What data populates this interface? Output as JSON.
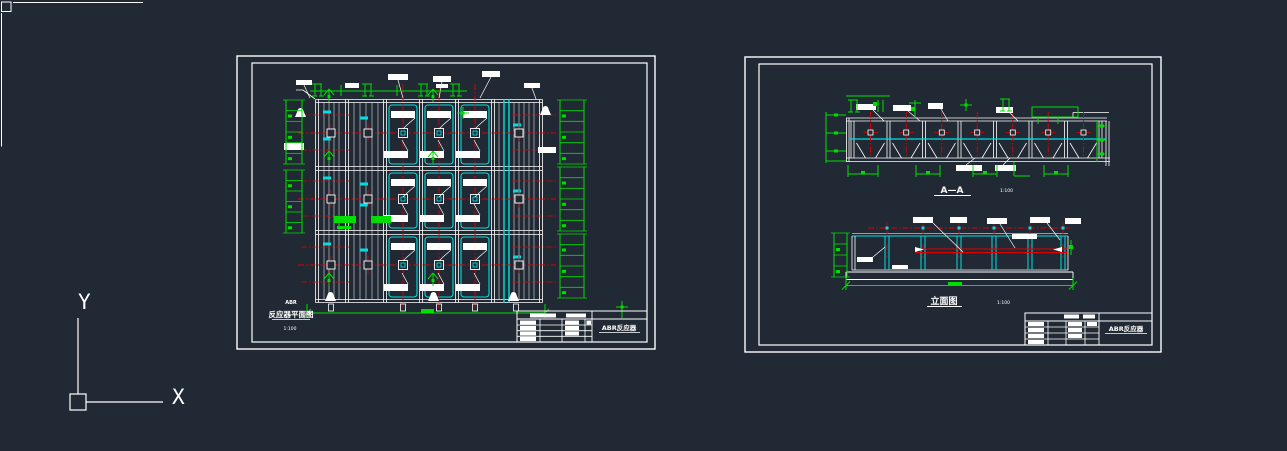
{
  "app": {
    "background_color": "#212934"
  },
  "colors": {
    "cad-bg": "#212934",
    "cad-white": "#ffffff",
    "cad-green": "#00dd00",
    "cad-red": "#e00000",
    "cad-cyan": "#00e0e0"
  },
  "ucs": {
    "y_label": "Y",
    "x_label": "X"
  },
  "sheet_left": {
    "caption": {
      "small": "ABR",
      "title": "反应器平面图",
      "scale": "1:100"
    },
    "title_block": {
      "drawing_title": "ABR反应器"
    }
  },
  "sheet_right": {
    "section_label": {
      "title": "A—A",
      "scale": "1:100"
    },
    "elevation_label": {
      "title": "立面图",
      "scale": "1:100"
    },
    "title_block": {
      "drawing_title": "ABR反应器"
    }
  }
}
